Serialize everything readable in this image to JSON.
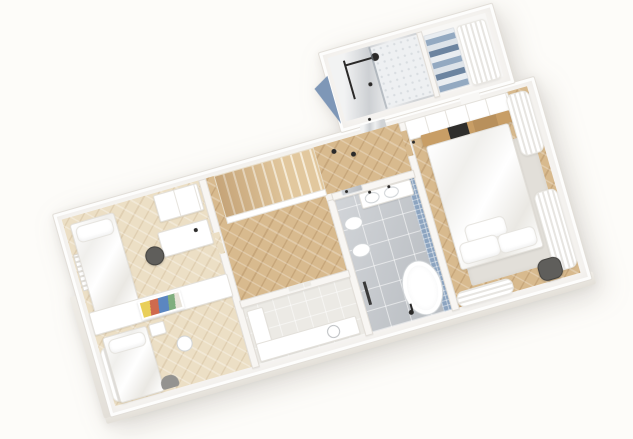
{
  "scene": {
    "type": "3d-floor-plan-render",
    "description": "Top-down 3D architectural render of an apartment floor, rotated on a plain background",
    "rooms": [
      {
        "id": "kids-bedroom-1",
        "label": "Bedroom with single bed, desk, black chair and wardrobe"
      },
      {
        "id": "kids-bedroom-2",
        "label": "Bedroom with single bed, shared desk console with colorful artwork"
      },
      {
        "id": "hallway",
        "label": "Hallway with wooden staircase and herringbone parquet"
      },
      {
        "id": "utility-room",
        "label": "Utility room with white cabinets and washer"
      },
      {
        "id": "bathroom",
        "label": "Bathroom with freestanding tub, double vanity, two wall-hung toilets and blue mosaic wall"
      },
      {
        "id": "shower-room",
        "label": "Shower room with marble walls, hex tile floor and black fixtures"
      },
      {
        "id": "closet",
        "label": "Walk-in closet with folded clothes shelves and hanging rail"
      },
      {
        "id": "master-bedroom",
        "label": "Master bedroom with double bed, wood headboard console, wardrobe and curtained windows"
      }
    ]
  },
  "colors": {
    "bg": "#fdfcf9",
    "wall": "#f6f4f1",
    "wallEdge": "#e2ded8",
    "wallInner": "#f8f6f3",
    "slab": "#efece6",
    "woodMid": "#d8ba8e",
    "woodLight": "#ecdfc5",
    "stairWood": "#e2c89e",
    "stairLight": "#f6ecd8",
    "tile": "#c3c7cc",
    "util": "#eceae5",
    "mosaic": "#8ca4c0",
    "marble": "#dadcde",
    "hexTile": "#eef0f2",
    "furnEdge": "#e3e0da",
    "curtainShade": "#e7e5e1",
    "rug": "#e2dfd9",
    "dark": "#2b2a29",
    "greyChair": "#5f5e5b",
    "pouf": "#949390",
    "woodAccent": "#c89e66",
    "woodDark": "#b8905c",
    "blackPanel": "#2f2e2c",
    "blueGlass": "#7e97b7",
    "artYellow": "#e9cf5a",
    "artRed": "#cf6a4d",
    "artBlue": "#5b86c0",
    "artGreen": "#7fae7e",
    "shelfBlue": "#93a9c1",
    "shelfNavy": "#6c84a0"
  }
}
